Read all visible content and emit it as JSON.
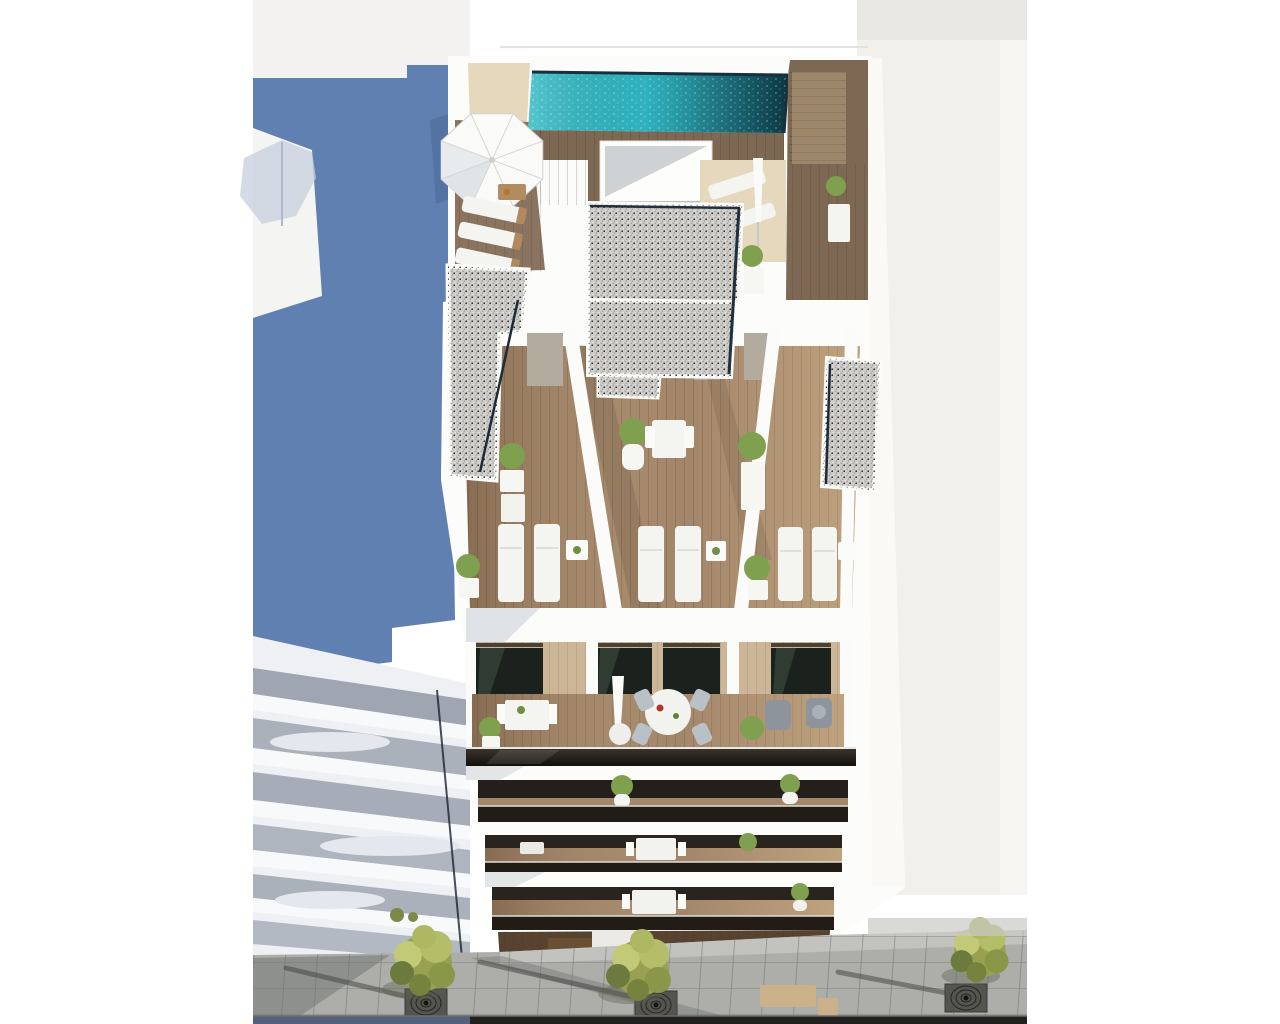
{
  "scene": {
    "type": "architectural-render",
    "description": "Aerial 3D render of a modern white apartment building: rooftop terrace with turquoise swimming pool, wood deck stairs, open parasol and sun loungers; penthouse terraces with gravel roof strips, potted plants and bistro sets; a row of terraces with paired white sun loungers; balconies with dining sets, armchairs and glass balustrades; paved street below with trees in grated planters; blue side wall of neighbouring building at left",
    "view": "high-angle bird's-eye view of street facade",
    "lighting": "bright daylight, sun from upper right, long soft shadows to lower left"
  },
  "colors": {
    "page_background": "#ffffff",
    "backdrop_offwhite": "#f1f0ed",
    "backdrop_top_strip": "#e9e8e4",
    "side_wall_blue": "#6080b2",
    "building_white": "#fcfcfa",
    "neighbor_band_gray": "#9aa1ad",
    "pool_water": "#2fb3be",
    "pool_edge_navy": "#16303f",
    "wood_walkway": "#7d6853",
    "wood_terrace": "#a3866a",
    "wood_backwall": "#cdb698",
    "sand_deck": "#e6d8bd",
    "gravel_roof": "#cdccc9",
    "glass_dark": "#1b211d",
    "balustrade_glass": "#221c16",
    "parasol_white": "#fafaf8",
    "furniture_white": "#f4f4f1",
    "armchair_gray": "#8d949b",
    "plant_green": "#7fa04f",
    "tree_canopy": "#97a151",
    "tree_highlight": "#c3ca77",
    "pavement_gray": "#adaeaa",
    "pavement_sunlit": "#c6c7c2",
    "road_asphalt": "#232120",
    "road_shadow_blue": "#55617c",
    "bench_tan": "#cbb189",
    "ground_floor_wood": "#57432f"
  },
  "inventory": {
    "street_trees": 3,
    "tree_grates": 3,
    "street_benches": 2,
    "rooftop": {
      "pools": 1,
      "open_parasols": 1,
      "standing_parasols": 1,
      "sun_loungers": 5,
      "potted_plants": 3,
      "deck_stair_flights": 1,
      "stairwell_boxes": 1
    },
    "terrace_level": {
      "units": 3,
      "gravel_roof_strips": 5,
      "potted_plants": 4,
      "bistro_sets": 2,
      "sun_loungers": 6,
      "side_tables": 3
    },
    "balcony_level": {
      "balconies": 3,
      "round_dining_tables": 1,
      "dining_chairs": 4,
      "armchairs": 2,
      "closed_parasols": 1,
      "potted_plants": 3
    },
    "lower_balconies": {
      "levels": 3,
      "tables_with_chairs": 2,
      "potted_plants": 4
    },
    "neighbor_buildings": {
      "left_balcony_slabs": 5,
      "left_side_wall": "blue",
      "parasol_shadows_on_walls": 2
    }
  }
}
